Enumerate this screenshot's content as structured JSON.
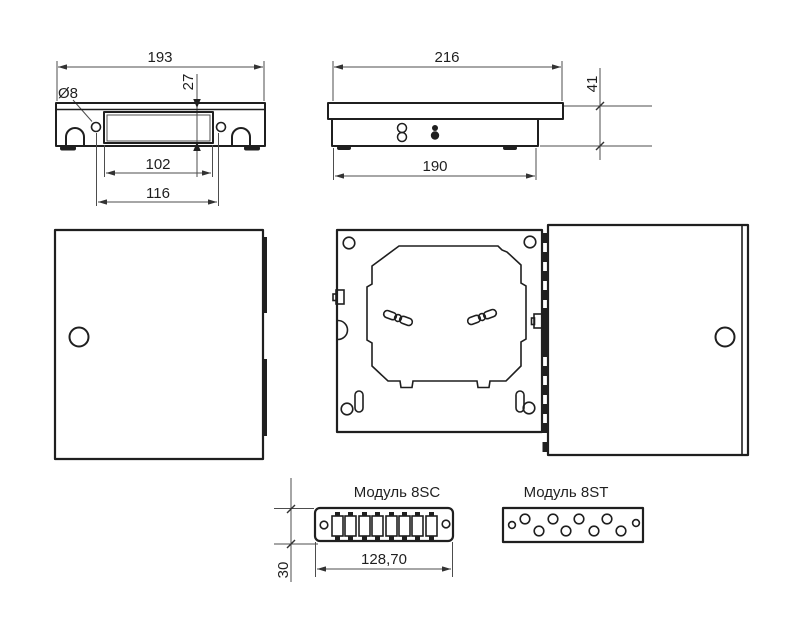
{
  "views": {
    "top": {
      "dims": {
        "overall_width": "193",
        "lid_offset": "27",
        "hole_diameter": "Ø8",
        "inner_width": "102",
        "hole_pitch": "116"
      }
    },
    "side": {
      "dims": {
        "cover_width": "216",
        "total_height": "41",
        "body_width": "190"
      }
    },
    "module_sc": {
      "title": "Модуль 8SC",
      "port_count": 8,
      "dims": {
        "width": "128,70",
        "height": "30"
      }
    },
    "module_st": {
      "title": "Модуль 8ST",
      "port_count": 8
    }
  },
  "colors": {
    "outline": "#1f1f1f",
    "dimension_line": "#4d4d4d",
    "text": "#1f1f1f",
    "background": "#ffffff"
  }
}
